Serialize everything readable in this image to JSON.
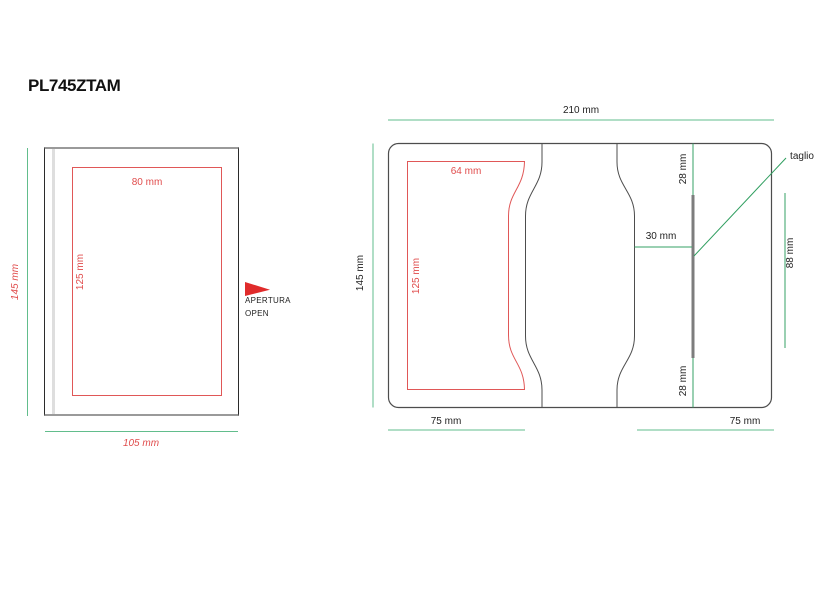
{
  "title": "PL745ZTAM",
  "closed_view": {
    "height_dim": "145 mm",
    "width_dim": "105 mm",
    "print_width_dim": "80 mm",
    "print_height_dim": "125 mm",
    "opening_label_line1": "APERTURA",
    "opening_label_line2": "OPEN"
  },
  "open_view": {
    "width_dim": "210 mm",
    "height_dim": "145 mm",
    "print_width_dim": "64 mm",
    "print_height_dim": "125 mm",
    "cut_top_offset_dim": "28 mm",
    "cut_bottom_offset_dim": "28 mm",
    "cut_inset_dim": "30 mm",
    "cut_length_dim": "88 mm",
    "cut_label": "taglio",
    "left_panel_dim": "75 mm",
    "right_panel_dim": "75 mm"
  },
  "colors": {
    "red": "#e04c4c",
    "green_dim_line": "#62bd8c",
    "green_strong_line": "#35a164",
    "cut_gray": "#7d7d7d",
    "outline_gray": "#4d4d4d"
  }
}
